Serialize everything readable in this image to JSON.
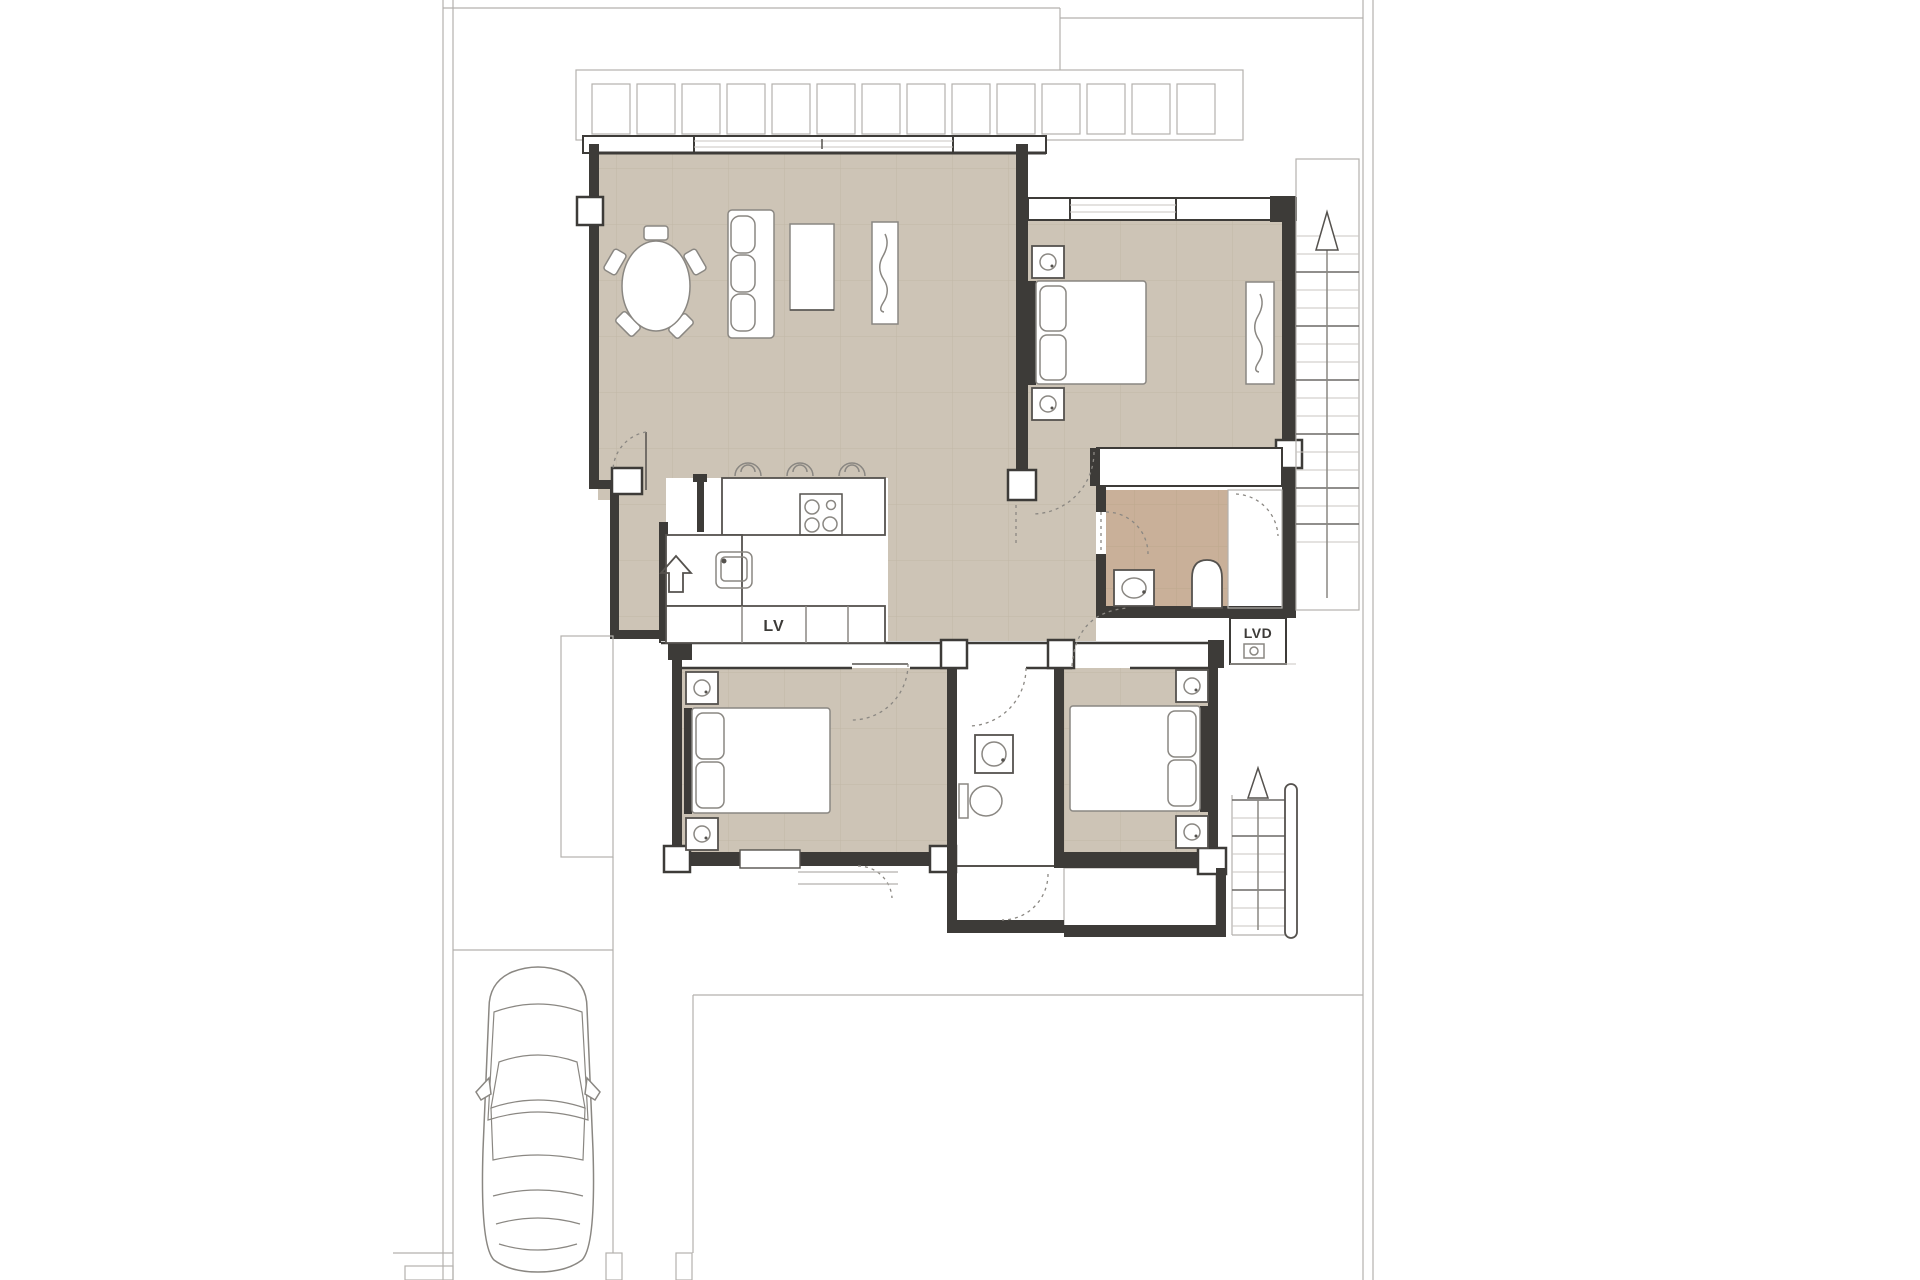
{
  "document": {
    "kind": "architectural-floor-plan"
  },
  "labels": {
    "dishwasher": "LV",
    "laundry": "LVD"
  },
  "colors": {
    "paper": "#ffffff",
    "floor": "#cdc4b6",
    "floor_grid": "#c1b7a7",
    "bath_floor": "#c9b099",
    "bath_grid": "#bda98d",
    "wall": "#3d3b38",
    "line_light": "#b3b1ad",
    "line_mid": "#8a8782",
    "line_dark": "#55524e"
  },
  "symbols": {
    "entry_arrow": "arrow-up",
    "upper_stair_arrow": "arrow-up",
    "lower_stair_arrow": "arrow-up"
  }
}
